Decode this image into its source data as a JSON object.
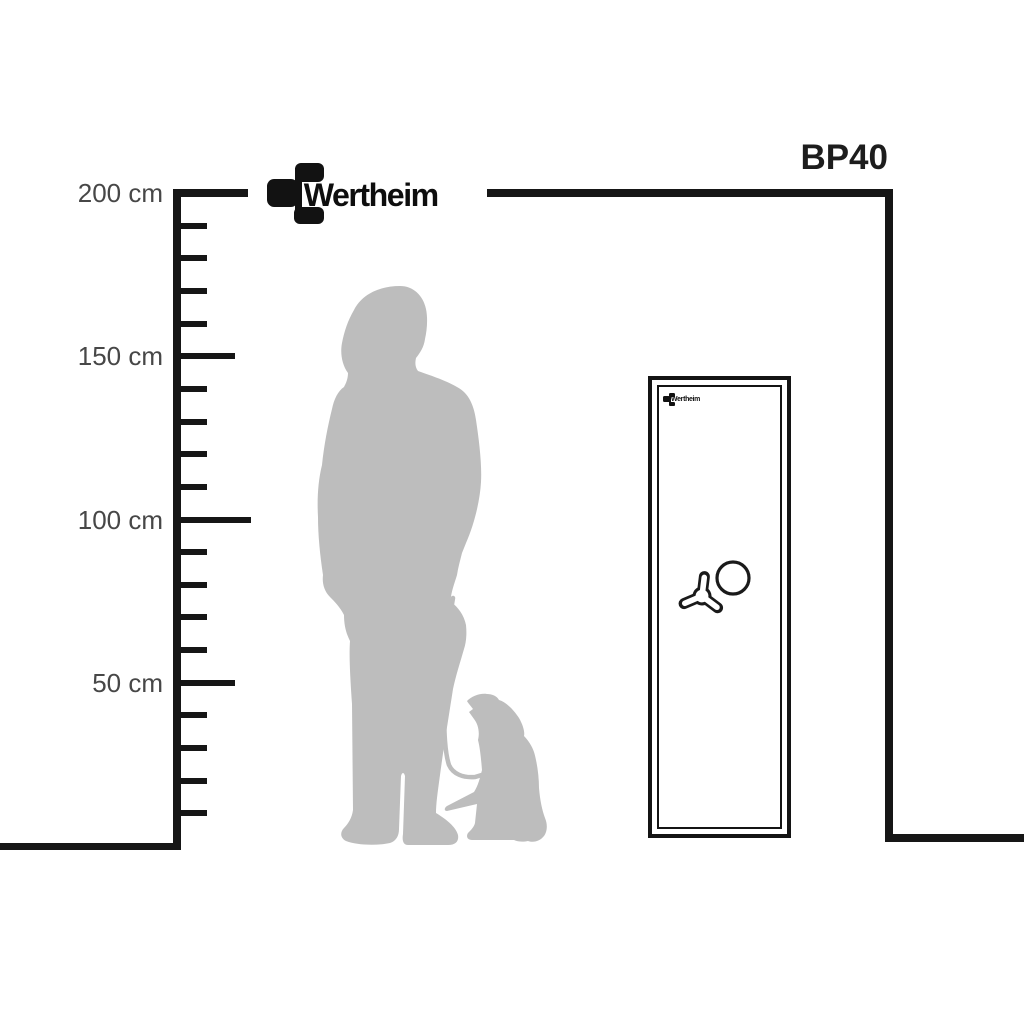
{
  "brand": {
    "name": "Wertheim"
  },
  "product": {
    "model": "BP40"
  },
  "ruler": {
    "unit": "cm",
    "min_cm": 0,
    "max_cm": 200,
    "tick_interval_cm": 10,
    "labeled_ticks": [
      {
        "cm": 200,
        "label": "200 cm"
      },
      {
        "cm": 150,
        "label": "150 cm"
      },
      {
        "cm": 100,
        "label": "100 cm"
      },
      {
        "cm": 50,
        "label": "50 cm"
      }
    ]
  },
  "figures": {
    "person": "woman-silhouette",
    "animal": "dog-on-leash-silhouette",
    "safe": "gun-safe-front-view",
    "safe_features": [
      "tri-spoke-handle-icon",
      "dial-knob-icon",
      "brand-logo"
    ]
  },
  "colors": {
    "line": "#161616",
    "label_text": "#474747",
    "model_text": "#1d1d1d",
    "silhouette": "#bdbdbd",
    "background": "#ffffff"
  }
}
